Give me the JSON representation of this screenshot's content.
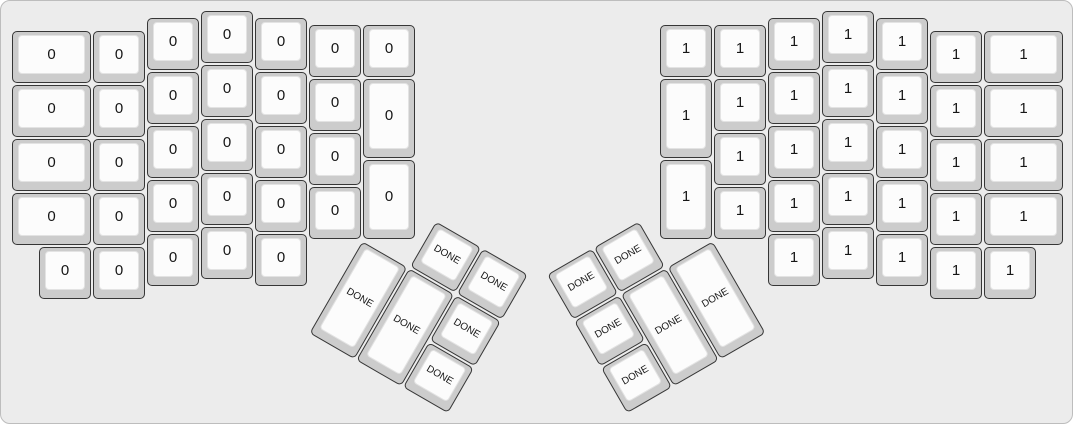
{
  "app": {
    "description": "keyboard layout render (ErgoDox split keyboard)",
    "canvas": {
      "width": 1073,
      "height": 424,
      "background": "#ececec",
      "border_color": "#bdbdbd"
    }
  },
  "key_style": {
    "unit_px": 54,
    "origin_x": 10,
    "origin_y": 9,
    "base_color": "#cccccc",
    "top_color": "#fcfcfc",
    "top_edge_color": "#e3e3e3",
    "border_color": "#363636",
    "label_color": "#161616"
  },
  "keyboard": {
    "groups": [
      {
        "name": "left-hand-main",
        "label": "0",
        "font_px": 15,
        "rotation": 0,
        "rx": 0,
        "ry": 0,
        "keys": [
          [
            0,
            0.375,
            1.5,
            1
          ],
          [
            1.5,
            0.375,
            1,
            1
          ],
          [
            2.5,
            0.125,
            1,
            1
          ],
          [
            3.5,
            0,
            1,
            1
          ],
          [
            4.5,
            0.125,
            1,
            1
          ],
          [
            5.5,
            0.25,
            1,
            1
          ],
          [
            6.5,
            0.25,
            1,
            1
          ],
          [
            0,
            1.375,
            1.5,
            1
          ],
          [
            1.5,
            1.375,
            1,
            1
          ],
          [
            2.5,
            1.125,
            1,
            1
          ],
          [
            3.5,
            1,
            1,
            1
          ],
          [
            4.5,
            1.125,
            1,
            1
          ],
          [
            5.5,
            1.25,
            1,
            1
          ],
          [
            6.5,
            1.25,
            1,
            1.5
          ],
          [
            0,
            2.375,
            1.5,
            1
          ],
          [
            1.5,
            2.375,
            1,
            1
          ],
          [
            2.5,
            2.125,
            1,
            1
          ],
          [
            3.5,
            2,
            1,
            1
          ],
          [
            4.5,
            2.125,
            1,
            1
          ],
          [
            5.5,
            2.25,
            1,
            1
          ],
          [
            6.5,
            2.75,
            1,
            1.5
          ],
          [
            0,
            3.375,
            1.5,
            1
          ],
          [
            1.5,
            3.375,
            1,
            1
          ],
          [
            2.5,
            3.125,
            1,
            1
          ],
          [
            3.5,
            3,
            1,
            1
          ],
          [
            4.5,
            3.125,
            1,
            1
          ],
          [
            5.5,
            3.25,
            1,
            1
          ],
          [
            0.5,
            4.375,
            1,
            1
          ],
          [
            1.5,
            4.375,
            1,
            1
          ],
          [
            2.5,
            4.125,
            1,
            1
          ],
          [
            3.5,
            4,
            1,
            1
          ],
          [
            4.5,
            4.125,
            1,
            1
          ]
        ]
      },
      {
        "name": "right-hand-main",
        "label": "1",
        "font_px": 15,
        "rotation": 0,
        "rx": 0,
        "ry": 0,
        "keys": [
          [
            12,
            0.25,
            1,
            1
          ],
          [
            13,
            0.25,
            1,
            1
          ],
          [
            14,
            0.125,
            1,
            1
          ],
          [
            15,
            0,
            1,
            1
          ],
          [
            16,
            0.125,
            1,
            1
          ],
          [
            17,
            0.375,
            1,
            1
          ],
          [
            18,
            0.375,
            1.5,
            1
          ],
          [
            12,
            1.25,
            1,
            1.5
          ],
          [
            13,
            1.25,
            1,
            1
          ],
          [
            14,
            1.125,
            1,
            1
          ],
          [
            15,
            1,
            1,
            1
          ],
          [
            16,
            1.125,
            1,
            1
          ],
          [
            17,
            1.375,
            1,
            1
          ],
          [
            18,
            1.375,
            1.5,
            1
          ],
          [
            12,
            2.75,
            1,
            1.5
          ],
          [
            13,
            2.25,
            1,
            1
          ],
          [
            14,
            2.125,
            1,
            1
          ],
          [
            15,
            2,
            1,
            1
          ],
          [
            16,
            2.125,
            1,
            1
          ],
          [
            17,
            2.375,
            1,
            1
          ],
          [
            18,
            2.375,
            1.5,
            1
          ],
          [
            13,
            3.25,
            1,
            1
          ],
          [
            14,
            3.125,
            1,
            1
          ],
          [
            15,
            3,
            1,
            1
          ],
          [
            16,
            3.125,
            1,
            1
          ],
          [
            17,
            3.375,
            1,
            1
          ],
          [
            18,
            3.375,
            1.5,
            1
          ],
          [
            14,
            4.125,
            1,
            1
          ],
          [
            15,
            4,
            1,
            1
          ],
          [
            16,
            4.125,
            1,
            1
          ],
          [
            17,
            4.375,
            1,
            1
          ],
          [
            18,
            4.375,
            1,
            1
          ]
        ]
      },
      {
        "name": "left-thumb-cluster",
        "label": "DONE",
        "font_px": 10,
        "rotation": 30,
        "rx": 6.5,
        "ry": 4.25,
        "keys": [
          [
            1,
            -1,
            1,
            1
          ],
          [
            2,
            -1,
            1,
            1
          ],
          [
            0,
            0,
            1,
            2
          ],
          [
            1,
            0,
            1,
            2
          ],
          [
            2,
            0,
            1,
            1
          ],
          [
            2,
            1,
            1,
            1
          ]
        ]
      },
      {
        "name": "right-thumb-cluster",
        "label": "DONE",
        "font_px": 10,
        "rotation": -30,
        "rx": 13,
        "ry": 4.25,
        "keys": [
          [
            -3,
            -1,
            1,
            1
          ],
          [
            -2,
            -1,
            1,
            1
          ],
          [
            -3,
            0,
            1,
            1
          ],
          [
            -2,
            0,
            1,
            2
          ],
          [
            -1,
            0,
            1,
            2
          ],
          [
            -3,
            1,
            1,
            1
          ]
        ]
      }
    ]
  }
}
